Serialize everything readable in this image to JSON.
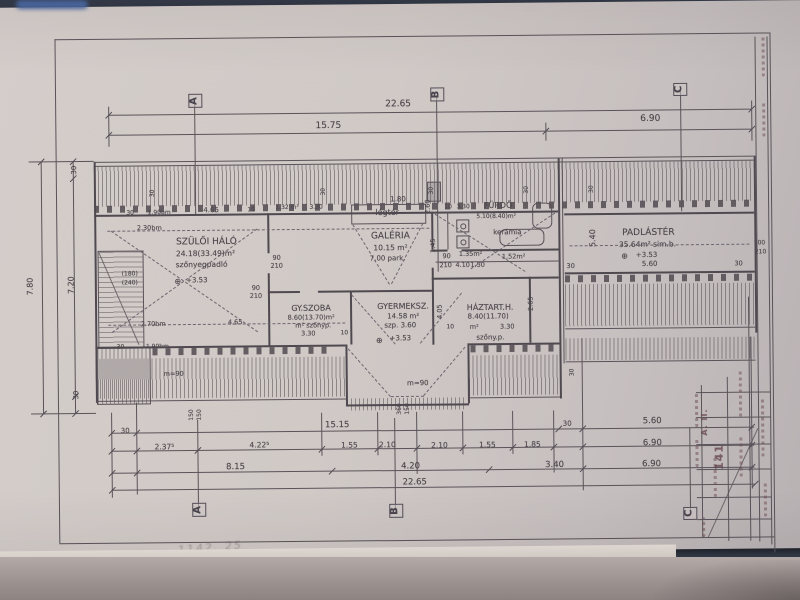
{
  "document": {
    "kind_note": "scanned hand-drawn attic floor plan, Hungarian",
    "overall_width": "22.65",
    "overall_height": "7.80",
    "top_dim_rows": [
      [
        "22.65"
      ],
      [
        "15.75",
        "6.90"
      ]
    ],
    "bottom_dim_rows": [
      [
        "30",
        "15.15",
        "30",
        "5.60"
      ],
      [
        "2.37⁵",
        "4.22⁵",
        "1.55",
        "2.10",
        "2.10",
        "1.55",
        "1.85",
        "6.90"
      ],
      [
        "8.15",
        "4.20",
        "3.40",
        "6.90"
      ],
      [
        "22.65"
      ]
    ],
    "left_dim_rows": [
      [
        "30",
        "7.20",
        "30"
      ],
      [
        "7.80"
      ]
    ],
    "section_markers": [
      "A",
      "B",
      "C"
    ]
  },
  "rooms": [
    {
      "name": "SZÜLŐI HÁLÓ",
      "area": "24.18(33.49)m²",
      "floor": "szőnyegpadló",
      "level": "+3.53"
    },
    {
      "name": "GY.SZOBA",
      "area": "8.60(13.70)m²",
      "floor": "m² szőnyp.",
      "dim": "3.30"
    },
    {
      "name": "GALÉRIA",
      "area": "10.15 m²",
      "floor": "7.00 park."
    },
    {
      "name": "GYERMEKSZ.",
      "area": "14.58 m²",
      "floor": "szp. 3.60",
      "level": "+3.53"
    },
    {
      "name": "FÜRDŐ",
      "area": "5.10(8.40)m²",
      "floor": "kerámia"
    },
    {
      "name": "HÁZTART.H.",
      "area": "8.40(11.70)",
      "floor": "szőny.p.",
      "dim": "3.30"
    },
    {
      "name": "PADLÁSTÉR",
      "area": "35.64m²",
      "floor": "sim.b.",
      "level": "+3.53",
      "dim": "5.60"
    },
    {
      "name": "légtér"
    }
  ],
  "colors": {
    "background": "#343a48",
    "paper": "#d0c9c6",
    "ink": "#5a545a",
    "stamp_ink": "#67454e",
    "corner_blue": "#4a67a0"
  },
  "labels": [
    {
      "t": "22.65",
      "x": 400,
      "y": 105,
      "s": 9
    },
    {
      "t": "15.75",
      "x": 330,
      "y": 126,
      "s": 9
    },
    {
      "t": "6.90",
      "x": 652,
      "y": 122,
      "s": 9
    },
    {
      "t": "A",
      "x": 197,
      "y": 99,
      "s": 10,
      "r": -90,
      "c": "marker",
      "n": "section-marker-a"
    },
    {
      "t": "B",
      "x": 439,
      "y": 95,
      "s": 10,
      "r": -90,
      "c": "marker",
      "n": "section-marker-b"
    },
    {
      "t": "C",
      "x": 682,
      "y": 92,
      "s": 10,
      "r": -90,
      "c": "marker",
      "n": "section-marker-c"
    },
    {
      "t": "A",
      "x": 197,
      "y": 508,
      "s": 10,
      "r": -90,
      "c": "marker",
      "n": "section-marker-a-bottom"
    },
    {
      "t": "B",
      "x": 394,
      "y": 511,
      "s": 10,
      "r": -90,
      "c": "marker",
      "n": "section-marker-b-bottom"
    },
    {
      "t": "C",
      "x": 688,
      "y": 516,
      "s": 10,
      "r": -90,
      "c": "marker",
      "n": "section-marker-c-bottom"
    },
    {
      "t": "30",
      "x": 76,
      "y": 167,
      "s": 7,
      "r": -90
    },
    {
      "t": "7.20",
      "x": 72,
      "y": 282,
      "s": 8,
      "r": -90
    },
    {
      "t": "7.80",
      "x": 31,
      "y": 283,
      "s": 8,
      "r": -90
    },
    {
      "t": "30",
      "x": 76,
      "y": 392,
      "s": 7,
      "r": -90
    },
    {
      "t": "30",
      "x": 154,
      "y": 191,
      "s": 6,
      "r": -90
    },
    {
      "t": "30",
      "x": 325,
      "y": 191,
      "s": 6,
      "r": -90
    },
    {
      "t": "30",
      "x": 433,
      "y": 191,
      "s": 6,
      "r": -90
    },
    {
      "t": "30",
      "x": 528,
      "y": 191,
      "s": 6,
      "r": -90
    },
    {
      "t": "30",
      "x": 593,
      "y": 191,
      "s": 6,
      "r": -90
    },
    {
      "t": "30",
      "x": 131,
      "y": 211,
      "s": 6
    },
    {
      "t": "1.90bm",
      "x": 160,
      "y": 211,
      "s": 6
    },
    {
      "t": "4.65",
      "x": 212,
      "y": 209,
      "s": 7
    },
    {
      "t": "10",
      "x": 252,
      "y": 209,
      "s": 6
    },
    {
      "t": "1.32 m²",
      "x": 288,
      "y": 207,
      "s": 6
    },
    {
      "t": "3.30",
      "x": 317,
      "y": 207,
      "s": 6
    },
    {
      "t": "1.80",
      "x": 399,
      "y": 200,
      "s": 7
    },
    {
      "t": "légtér",
      "x": 388,
      "y": 213,
      "s": 8,
      "n": "room-label-legter"
    },
    {
      "t": "10",
      "x": 449,
      "y": 208,
      "s": 6
    },
    {
      "t": "3.30",
      "x": 464,
      "y": 208,
      "s": 6
    },
    {
      "t": "FÜRDŐ",
      "x": 499,
      "y": 207,
      "s": 8,
      "n": "room-label-furdo"
    },
    {
      "t": "5.10(8.40)m²",
      "x": 497,
      "y": 218,
      "s": 6
    },
    {
      "t": "kerámia",
      "x": 508,
      "y": 234,
      "s": 7
    },
    {
      "t": "2.30bm",
      "x": 150,
      "y": 226,
      "s": 6.5
    },
    {
      "t": "SZÜLŐI HÁLÓ",
      "x": 207,
      "y": 241,
      "s": 9,
      "n": "room-label-szuloi-halo"
    },
    {
      "t": "24.18(33.49)m²",
      "x": 206,
      "y": 252,
      "s": 7.5
    },
    {
      "t": "szőnyegpadló",
      "x": 202,
      "y": 263,
      "s": 7.5
    },
    {
      "t": "⊕",
      "x": 178,
      "y": 280,
      "s": 8,
      "n": "level-mark-icon"
    },
    {
      "t": "+3.53",
      "x": 197,
      "y": 279,
      "s": 7
    },
    {
      "t": "(180)",
      "x": 130,
      "y": 272,
      "s": 6
    },
    {
      "t": "(240)",
      "x": 130,
      "y": 281,
      "s": 6
    },
    {
      "t": "90",
      "x": 277,
      "y": 257,
      "s": 6.5
    },
    {
      "t": "210",
      "x": 277,
      "y": 265,
      "s": 6.5
    },
    {
      "t": "2.70bm",
      "x": 153,
      "y": 322,
      "s": 6.5
    },
    {
      "t": "4.65",
      "x": 235,
      "y": 321,
      "s": 6.5
    },
    {
      "t": "1.90bm",
      "x": 157,
      "y": 345,
      "s": 6
    },
    {
      "t": "30",
      "x": 120,
      "y": 345,
      "s": 6
    },
    {
      "t": "90",
      "x": 256,
      "y": 287,
      "s": 6.5
    },
    {
      "t": "210",
      "x": 256,
      "y": 295,
      "s": 6.5
    },
    {
      "t": "GY.SZOBA",
      "x": 311,
      "y": 308,
      "s": 8,
      "n": "room-label-gyszoba"
    },
    {
      "t": "8.60(13.70)m²",
      "x": 311,
      "y": 317,
      "s": 6.5
    },
    {
      "t": "m² szőnyp.",
      "x": 313,
      "y": 325,
      "s": 6.5
    },
    {
      "t": "3.30",
      "x": 308,
      "y": 333,
      "s": 6.5
    },
    {
      "t": "10",
      "x": 344,
      "y": 333,
      "s": 6
    },
    {
      "t": "GALÉRIA",
      "x": 391,
      "y": 237,
      "s": 9,
      "n": "room-label-galeria"
    },
    {
      "t": "10.15 m²",
      "x": 391,
      "y": 248,
      "s": 7.5
    },
    {
      "t": "7.00 park.",
      "x": 388,
      "y": 259,
      "s": 7
    },
    {
      "t": "2.60",
      "x": 429,
      "y": 207,
      "s": 6.5,
      "r": -90
    },
    {
      "t": "1.45",
      "x": 434,
      "y": 246,
      "s": 6.5,
      "r": -90
    },
    {
      "t": "90",
      "x": 447,
      "y": 257,
      "s": 6.5
    },
    {
      "t": "210",
      "x": 446,
      "y": 266,
      "s": 6.5
    },
    {
      "t": "4.10",
      "x": 463,
      "y": 266,
      "s": 6.5
    },
    {
      "t": "1.50",
      "x": 478,
      "y": 266,
      "s": 6.5
    },
    {
      "t": "1.35m²",
      "x": 471,
      "y": 255,
      "s": 6.5
    },
    {
      "t": "1.52m²",
      "x": 514,
      "y": 258,
      "s": 6.5
    },
    {
      "t": "4.05",
      "x": 440,
      "y": 312,
      "s": 6.5,
      "r": -90
    },
    {
      "t": "GYERMEKSZ.",
      "x": 403,
      "y": 307,
      "s": 8,
      "n": "room-label-gyermeksz"
    },
    {
      "t": "14.58 m²",
      "x": 403,
      "y": 317,
      "s": 7
    },
    {
      "t": "szp. 3.60",
      "x": 400,
      "y": 326,
      "s": 7
    },
    {
      "t": "⊕",
      "x": 379,
      "y": 341,
      "s": 8,
      "n": "level-mark-icon"
    },
    {
      "t": "+3.53",
      "x": 400,
      "y": 339,
      "s": 7
    },
    {
      "t": "m=90",
      "x": 417,
      "y": 384,
      "s": 7
    },
    {
      "t": "m=90",
      "x": 173,
      "y": 372,
      "s": 6.5
    },
    {
      "t": "360",
      "x": 399,
      "y": 409,
      "s": 6,
      "r": -90
    },
    {
      "t": "150",
      "x": 407,
      "y": 409,
      "s": 6,
      "r": -90
    },
    {
      "t": "150",
      "x": 191,
      "y": 413,
      "s": 6,
      "r": -90
    },
    {
      "t": "150",
      "x": 199,
      "y": 413,
      "s": 6,
      "r": -90
    },
    {
      "t": "30",
      "x": 572,
      "y": 374,
      "s": 6,
      "r": -90
    },
    {
      "t": "HÁZTART.H.",
      "x": 490,
      "y": 309,
      "s": 8,
      "n": "room-label-haztart"
    },
    {
      "t": "8.40(11.70)",
      "x": 488,
      "y": 318,
      "s": 7
    },
    {
      "t": "m²",
      "x": 474,
      "y": 328,
      "s": 6.5
    },
    {
      "t": "3.30",
      "x": 507,
      "y": 328,
      "s": 6.5
    },
    {
      "t": "szőny.p.",
      "x": 490,
      "y": 339,
      "s": 7
    },
    {
      "t": "10",
      "x": 450,
      "y": 328,
      "s": 6
    },
    {
      "t": "2.65",
      "x": 531,
      "y": 305,
      "s": 6.5,
      "r": -90
    },
    {
      "t": "PADLÁSTÉR",
      "x": 649,
      "y": 236,
      "s": 9,
      "n": "room-label-padlaster"
    },
    {
      "t": "35.64m² sim.b.",
      "x": 648,
      "y": 247,
      "s": 7.5
    },
    {
      "t": "⊕",
      "x": 625,
      "y": 259,
      "s": 8,
      "n": "level-mark-icon"
    },
    {
      "t": "+3.53",
      "x": 647,
      "y": 258,
      "s": 7
    },
    {
      "t": "5.60",
      "x": 650,
      "y": 267,
      "s": 7
    },
    {
      "t": "5.40",
      "x": 594,
      "y": 240,
      "s": 8,
      "r": -90
    },
    {
      "t": "30",
      "x": 571,
      "y": 268,
      "s": 6.5
    },
    {
      "t": "30",
      "x": 739,
      "y": 267,
      "s": 6.5
    },
    {
      "t": "100",
      "x": 760,
      "y": 247,
      "s": 6
    },
    {
      "t": "210",
      "x": 761,
      "y": 256,
      "s": 6
    },
    {
      "t": "30",
      "x": 124,
      "y": 429,
      "s": 7
    },
    {
      "t": "15.15",
      "x": 336,
      "y": 425,
      "s": 8.5
    },
    {
      "t": "30",
      "x": 566,
      "y": 426,
      "s": 7
    },
    {
      "t": "5.60",
      "x": 651,
      "y": 424,
      "s": 8.5
    },
    {
      "t": "2.37⁵",
      "x": 163,
      "y": 445,
      "s": 7.5
    },
    {
      "t": "4.22⁵",
      "x": 258,
      "y": 444,
      "s": 7.5
    },
    {
      "t": "1.55",
      "x": 348,
      "y": 445,
      "s": 7.5
    },
    {
      "t": "2.10",
      "x": 386,
      "y": 445,
      "s": 7.5
    },
    {
      "t": "2.10",
      "x": 438,
      "y": 446,
      "s": 7.5
    },
    {
      "t": "1.55",
      "x": 486,
      "y": 446,
      "s": 7.5
    },
    {
      "t": "1.85",
      "x": 531,
      "y": 446,
      "s": 7.5
    },
    {
      "t": "6.90",
      "x": 651,
      "y": 446,
      "s": 8.5
    },
    {
      "t": "8.15",
      "x": 234,
      "y": 466,
      "s": 8.5
    },
    {
      "t": "4.20",
      "x": 409,
      "y": 467,
      "s": 8.5
    },
    {
      "t": "3.40",
      "x": 553,
      "y": 467,
      "s": 8.5
    },
    {
      "t": "6.90",
      "x": 650,
      "y": 467,
      "s": 8.5
    },
    {
      "t": "22.65",
      "x": 413,
      "y": 483,
      "s": 8.5
    },
    {
      "t": "A. II.",
      "x": 704,
      "y": 425,
      "s": 8,
      "r": -90,
      "c": "stamp",
      "n": "stamp-text"
    },
    {
      "t": "141",
      "x": 718,
      "y": 460,
      "s": 11,
      "r": -90,
      "c": "stamp",
      "n": "stamp-text"
    },
    {
      "t": "1142. 25",
      "x": 208,
      "y": 546,
      "s": 11,
      "r": -4,
      "c": "hand",
      "n": "handwritten-note"
    }
  ]
}
